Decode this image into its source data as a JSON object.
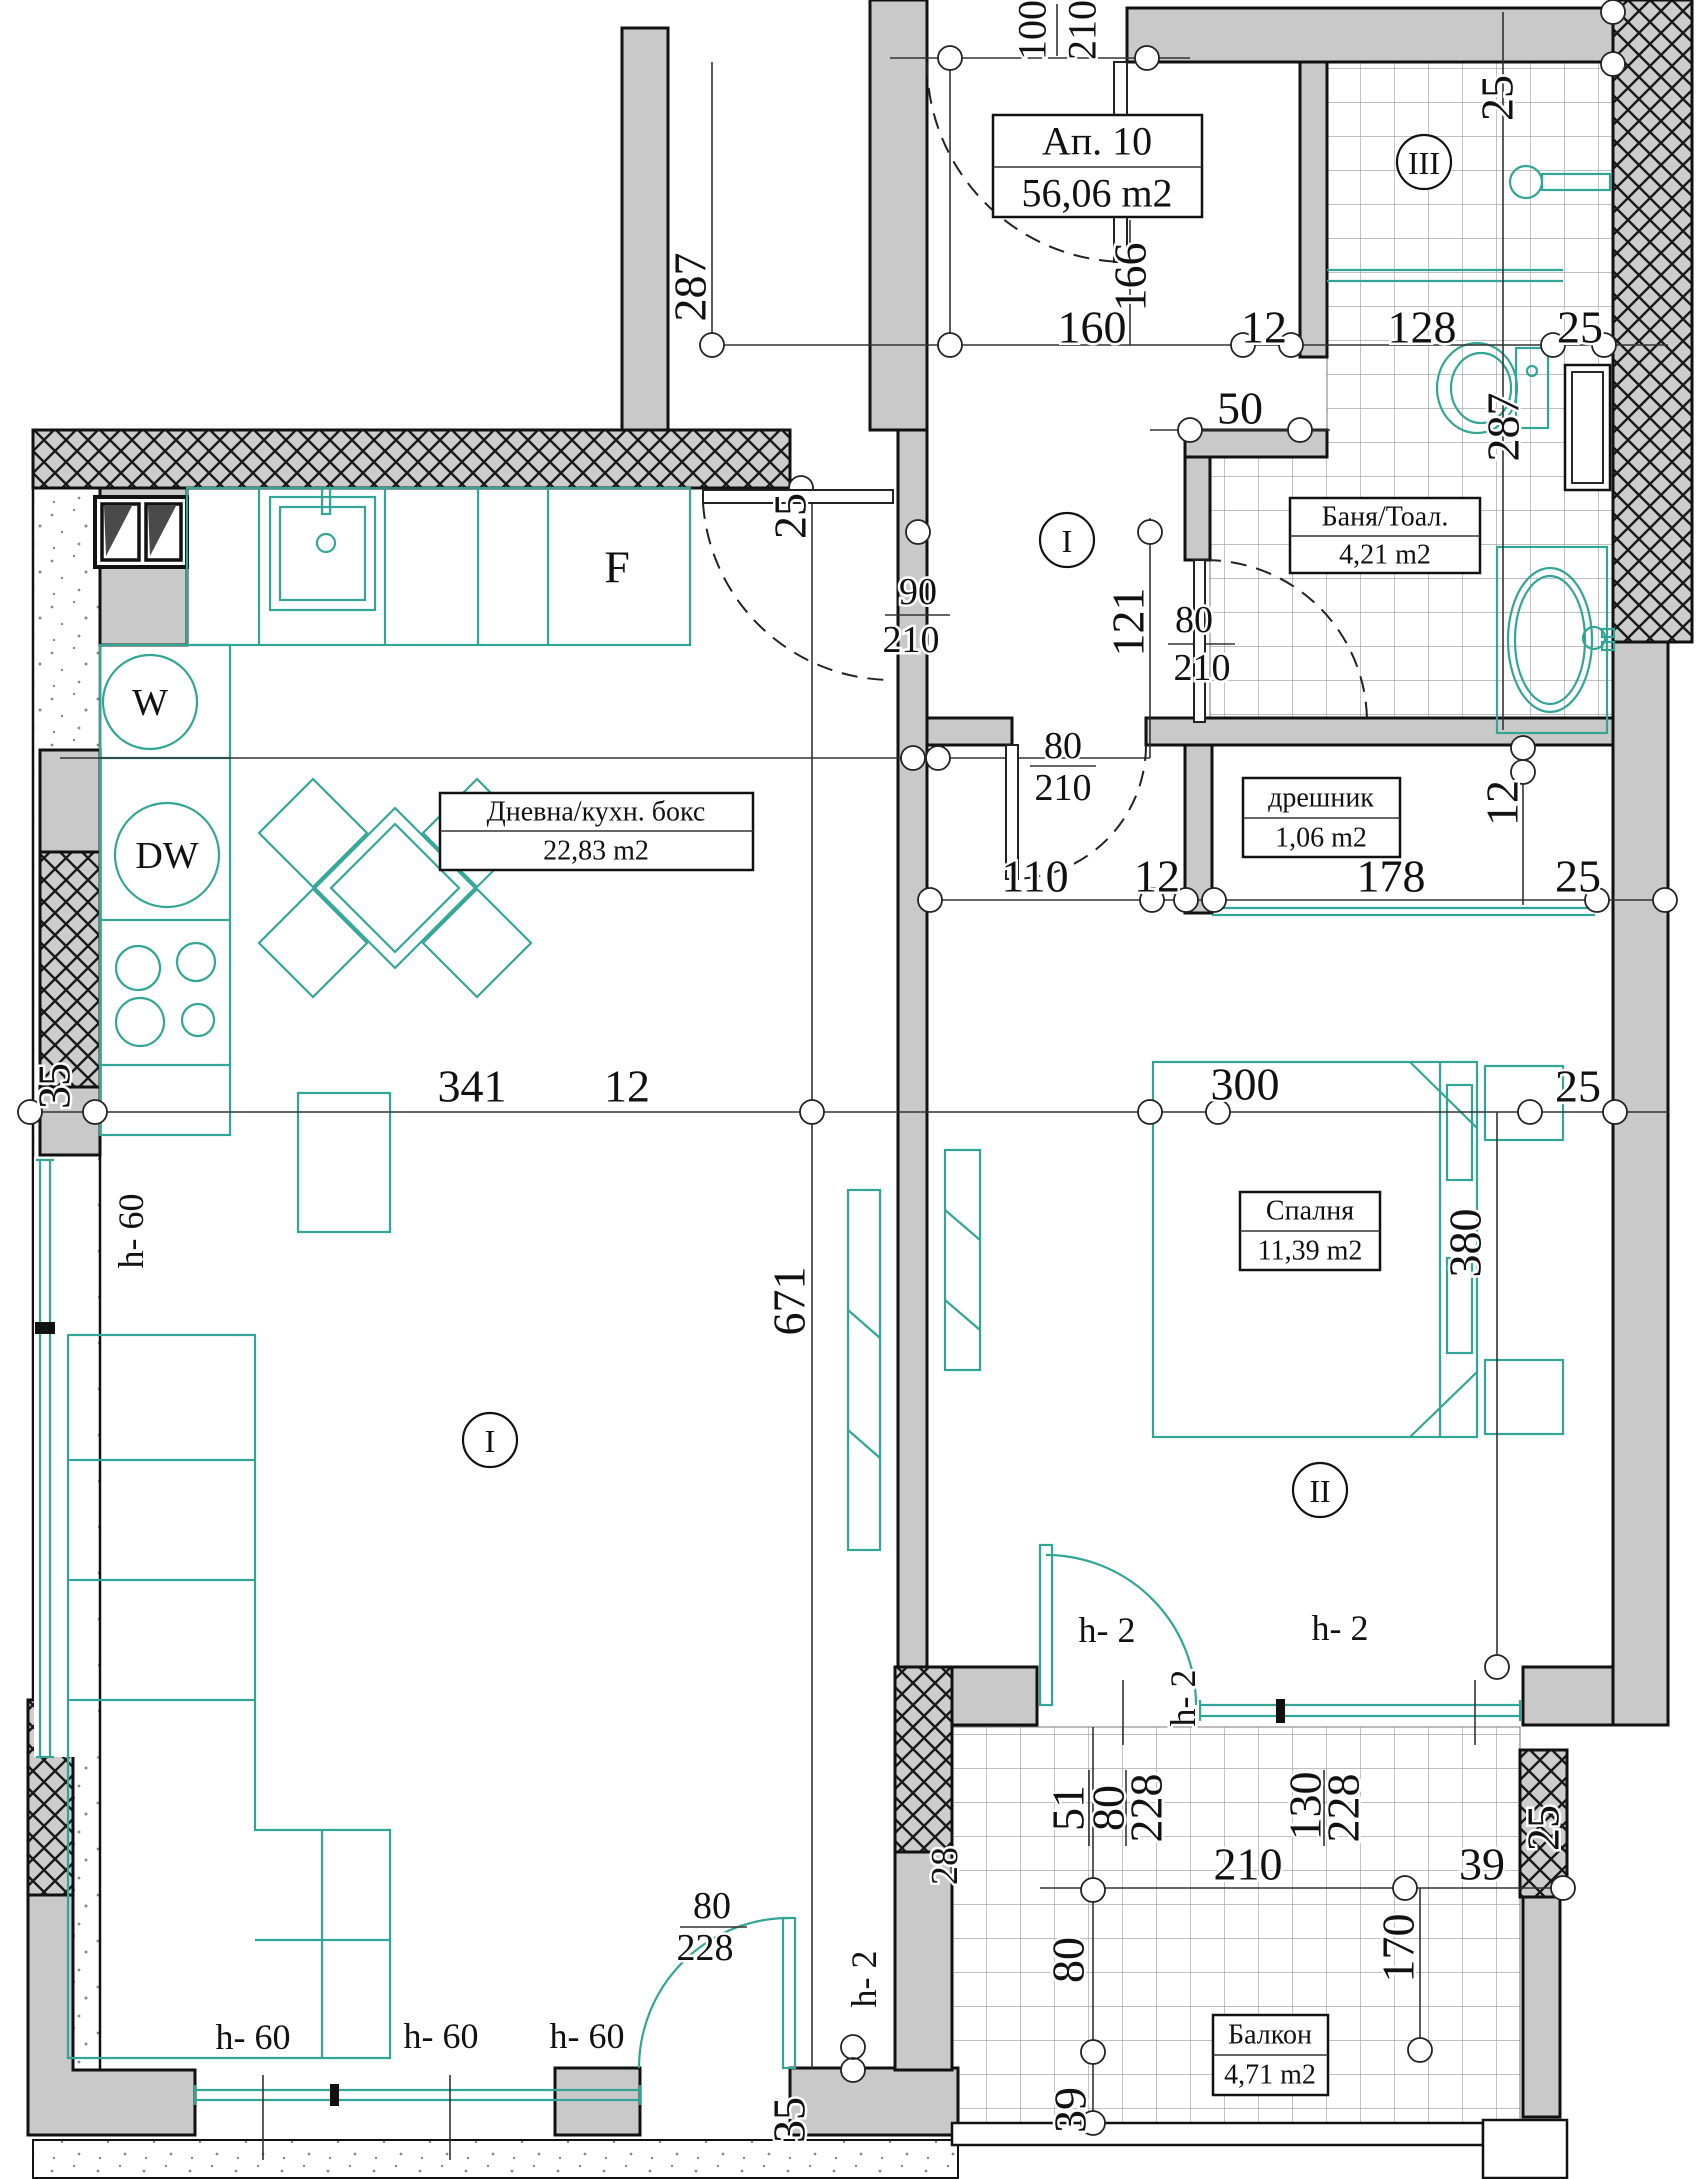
{
  "title": {
    "name": "Ап. 10",
    "area": "56,06 m2"
  },
  "rooms": {
    "living": {
      "name": "Дневна/кухн. бокс",
      "area": "22,83 m2",
      "marker": "I"
    },
    "bath": {
      "name": "Баня/Тоал.",
      "area": "4,21 m2",
      "marker": "III"
    },
    "closet": {
      "name": "дрешник",
      "area": "1,06 m2"
    },
    "bedroom": {
      "name": "Спалня",
      "area": "11,39 m2",
      "marker": "II"
    },
    "balcony": {
      "name": "Балкон",
      "area": "4,71 m2"
    },
    "hall": {
      "marker": "I"
    }
  },
  "appliances": {
    "fridge": "F",
    "washer": "W",
    "dishwasher": "DW"
  },
  "colors": {
    "teal": "#33a596",
    "wall_gray": "#c9c9c9",
    "line": "#1a1a1a"
  },
  "dimensions": [
    {
      "t": "100",
      "x": 1032,
      "y": 30,
      "r": -90,
      "s": 40
    },
    {
      "t": "210",
      "x": 1082,
      "y": 30,
      "r": -90,
      "s": 40
    },
    {
      "t": "166",
      "x": 1130,
      "y": 277,
      "r": -90
    },
    {
      "t": "287",
      "x": 690,
      "y": 287,
      "r": -90
    },
    {
      "t": "160",
      "x": 1092,
      "y": 327
    },
    {
      "t": "12",
      "x": 1264,
      "y": 327
    },
    {
      "t": "128",
      "x": 1422,
      "y": 327
    },
    {
      "t": "25",
      "x": 1580,
      "y": 327
    },
    {
      "t": "50",
      "x": 1240,
      "y": 408
    },
    {
      "t": "25",
      "x": 1497,
      "y": 98,
      "r": -90
    },
    {
      "t": "287",
      "x": 1503,
      "y": 427,
      "r": -90
    },
    {
      "t": "121",
      "x": 1128,
      "y": 622,
      "r": -90
    },
    {
      "t": "25",
      "x": 790,
      "y": 516,
      "r": -90
    },
    {
      "t": "90",
      "x": 918,
      "y": 592,
      "s": 38
    },
    {
      "t": "210",
      "x": 911,
      "y": 640,
      "s": 38
    },
    {
      "t": "80",
      "x": 1194,
      "y": 620,
      "s": 38
    },
    {
      "t": "210",
      "x": 1202,
      "y": 668,
      "s": 38
    },
    {
      "t": "80",
      "x": 1063,
      "y": 746,
      "s": 38
    },
    {
      "t": "210",
      "x": 1063,
      "y": 788,
      "s": 38
    },
    {
      "t": "110",
      "x": 1035,
      "y": 876
    },
    {
      "t": "12",
      "x": 1157,
      "y": 876
    },
    {
      "t": "178",
      "x": 1391,
      "y": 876
    },
    {
      "t": "25",
      "x": 1578,
      "y": 876
    },
    {
      "t": "12",
      "x": 1502,
      "y": 803,
      "r": -90
    },
    {
      "t": "35",
      "x": 54,
      "y": 1086,
      "r": -90
    },
    {
      "t": "341",
      "x": 472,
      "y": 1086
    },
    {
      "t": "12",
      "x": 627,
      "y": 1086
    },
    {
      "t": "300",
      "x": 1245,
      "y": 1084
    },
    {
      "t": "25",
      "x": 1578,
      "y": 1086
    },
    {
      "t": "671",
      "x": 789,
      "y": 1301,
      "r": -90
    },
    {
      "t": "380",
      "x": 1465,
      "y": 1243,
      "r": -90
    },
    {
      "t": "h- 60",
      "x": 131,
      "y": 1231,
      "r": -90,
      "s": 36
    },
    {
      "t": "h- 60",
      "x": 253,
      "y": 2037,
      "s": 36
    },
    {
      "t": "h- 60",
      "x": 441,
      "y": 2036,
      "s": 36
    },
    {
      "t": "h- 60",
      "x": 587,
      "y": 2036,
      "s": 36
    },
    {
      "t": "h- 2",
      "x": 1107,
      "y": 1630,
      "s": 36
    },
    {
      "t": "h- 2",
      "x": 1340,
      "y": 1628,
      "s": 36
    },
    {
      "t": "h- 2",
      "x": 1183,
      "y": 1698,
      "r": -90,
      "s": 36
    },
    {
      "t": "h- 2",
      "x": 864,
      "y": 1979,
      "r": -90,
      "s": 36
    },
    {
      "t": "51",
      "x": 1068,
      "y": 1808,
      "r": -90
    },
    {
      "t": "80",
      "x": 1108,
      "y": 1808,
      "r": -90
    },
    {
      "t": "228",
      "x": 1146,
      "y": 1808,
      "r": -90
    },
    {
      "t": "130",
      "x": 1305,
      "y": 1806,
      "r": -90
    },
    {
      "t": "228",
      "x": 1343,
      "y": 1808,
      "r": -90
    },
    {
      "t": "210",
      "x": 1248,
      "y": 1864
    },
    {
      "t": "39",
      "x": 1482,
      "y": 1864
    },
    {
      "t": "170",
      "x": 1398,
      "y": 1948,
      "r": -90
    },
    {
      "t": "80",
      "x": 1068,
      "y": 1960,
      "r": -90
    },
    {
      "t": "39",
      "x": 1070,
      "y": 2110,
      "r": -90
    },
    {
      "t": "25",
      "x": 1543,
      "y": 1828,
      "r": -90
    },
    {
      "t": "28",
      "x": 945,
      "y": 1866,
      "r": -90,
      "s": 38
    },
    {
      "t": "80",
      "x": 712,
      "y": 1906,
      "s": 38
    },
    {
      "t": "228",
      "x": 705,
      "y": 1948,
      "s": 38
    },
    {
      "t": "35",
      "x": 789,
      "y": 2120,
      "r": -90
    }
  ]
}
